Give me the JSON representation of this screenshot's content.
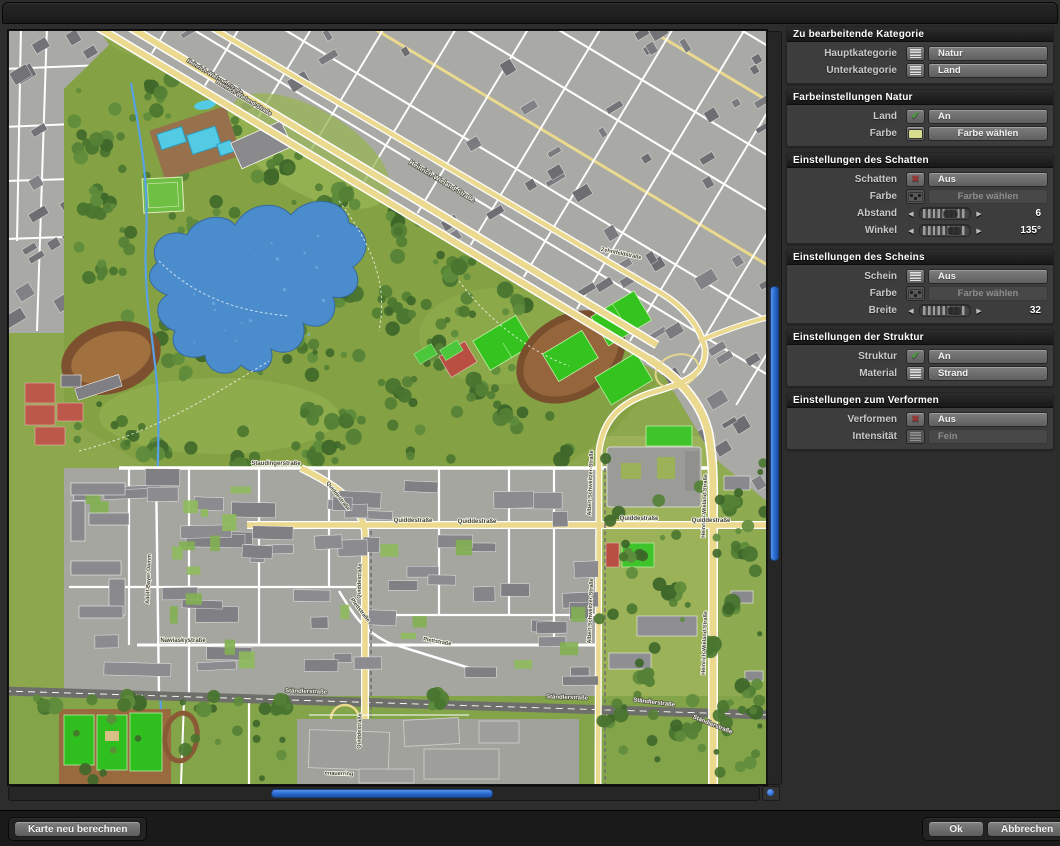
{
  "panel": {
    "sections": [
      {
        "title": "Zu bearbeitende Kategorie",
        "rows": [
          {
            "label": "Hauptkategorie",
            "type": "combo",
            "icon": "menu-icon",
            "value": "Natur"
          },
          {
            "label": "Unterkategorie",
            "type": "combo",
            "icon": "menu-icon",
            "value": "Land"
          }
        ]
      },
      {
        "title": "Farbeinstellungen Natur",
        "rows": [
          {
            "label": "Land",
            "type": "combo",
            "icon": "check-icon",
            "value": "An"
          },
          {
            "label": "Farbe",
            "type": "color",
            "icon": "swatch-icon",
            "value": "Farbe wählen"
          }
        ]
      },
      {
        "title": "Einstellungen des Schatten",
        "rows": [
          {
            "label": "Schatten",
            "type": "combo",
            "icon": "x-icon",
            "value": "Aus"
          },
          {
            "label": "Farbe",
            "type": "color",
            "icon": "checker-swatch-icon",
            "value": "Farbe wählen",
            "disabled": true
          },
          {
            "label": "Abstand",
            "type": "slider",
            "value": "6",
            "handle_frac": 0.62
          },
          {
            "label": "Winkel",
            "type": "slider",
            "value": "135°",
            "handle_frac": 0.72
          }
        ]
      },
      {
        "title": "Einstellungen des Scheins",
        "rows": [
          {
            "label": "Schein",
            "type": "combo",
            "icon": "menu-icon",
            "value": "Aus"
          },
          {
            "label": "Farbe",
            "type": "color",
            "icon": "checker-swatch-icon",
            "value": "Farbe wählen",
            "disabled": true
          },
          {
            "label": "Breite",
            "type": "slider",
            "value": "32",
            "handle_frac": 0.72
          }
        ]
      },
      {
        "title": "Einstellungen der Struktur",
        "rows": [
          {
            "label": "Struktur",
            "type": "combo",
            "icon": "check-icon",
            "value": "An"
          },
          {
            "label": "Material",
            "type": "combo",
            "icon": "menu-icon",
            "value": "Strand"
          }
        ]
      },
      {
        "title": "Einstellungen zum Verformen",
        "rows": [
          {
            "label": "Verformen",
            "type": "combo",
            "icon": "x-icon",
            "value": "Aus"
          },
          {
            "label": "Intensität",
            "type": "combo",
            "icon": "menu-icon",
            "value": "Fein",
            "disabled": true
          }
        ]
      }
    ]
  },
  "footer": {
    "recalculate": "Karte neu berechnen",
    "ok": "Ok",
    "cancel": "Abbrechen"
  },
  "colors": {
    "accent_blue": "#2e6fd6",
    "swatch_yellow_green": "#d7dd8d",
    "check_green": "#3fa32f",
    "cross_red": "#9e3434"
  },
  "map": {
    "labels": [
      {
        "text": "Heinrich-Wieland-Straße",
        "x": 205,
        "y": 47,
        "rot": 31,
        "style": "light",
        "size": 5.5
      },
      {
        "text": "Heinrich-Wieland-Straße",
        "x": 234,
        "y": 68,
        "rot": 31,
        "style": "light",
        "size": 5.5
      },
      {
        "text": "Heinrich-Wieland-Straße",
        "x": 432,
        "y": 152,
        "rot": 31,
        "style": "light",
        "size": 6.5
      },
      {
        "text": "Heinrich-Wieland-Straße",
        "x": 697,
        "y": 475,
        "rot": -88,
        "style": "dark",
        "size": 5.5
      },
      {
        "text": "Heinrich-Wieland-Straße",
        "x": 697,
        "y": 612,
        "rot": -88,
        "style": "dark",
        "size": 5.5
      },
      {
        "text": "Zehntfeldstraße",
        "x": 612,
        "y": 224,
        "rot": 12,
        "style": "dark",
        "size": 5.5
      },
      {
        "text": "Staudingerstraße",
        "x": 267,
        "y": 434,
        "rot": 0,
        "style": "dark",
        "size": 6
      },
      {
        "text": "Quiddestraße",
        "x": 328,
        "y": 466,
        "rot": 52,
        "style": "dark",
        "size": 5.5
      },
      {
        "text": "Quiddestraße",
        "x": 404,
        "y": 491,
        "rot": 0,
        "style": "dark",
        "size": 6
      },
      {
        "text": "Quiddestraße",
        "x": 468,
        "y": 492,
        "rot": 0,
        "style": "dark",
        "size": 6
      },
      {
        "text": "Quiddestraße",
        "x": 630,
        "y": 489,
        "rot": 0,
        "style": "dark",
        "size": 6
      },
      {
        "text": "Quiddestraße",
        "x": 702,
        "y": 491,
        "rot": 0,
        "style": "dark",
        "size": 6
      },
      {
        "text": "Quiddestraße",
        "x": 352,
        "y": 550,
        "rot": -88,
        "style": "dark",
        "size": 5.5
      },
      {
        "text": "Quiddestraße",
        "x": 352,
        "y": 700,
        "rot": -88,
        "style": "dark",
        "size": 5.5
      },
      {
        "text": "Plettstraße",
        "x": 350,
        "y": 580,
        "rot": 52,
        "style": "dark",
        "size": 5.5
      },
      {
        "text": "Plettstraße",
        "x": 428,
        "y": 612,
        "rot": 10,
        "style": "dark",
        "size": 5.5
      },
      {
        "text": "Nawiaskystraße",
        "x": 174,
        "y": 611,
        "rot": 0,
        "style": "dark",
        "size": 6
      },
      {
        "text": "Adolf-Bayer-Damm",
        "x": 141,
        "y": 548,
        "rot": -88,
        "style": "dark",
        "size": 5.5
      },
      {
        "text": "Albert-Schweitzer-Straße",
        "x": 583,
        "y": 452,
        "rot": -88,
        "style": "dark",
        "size": 5.5
      },
      {
        "text": "Albert-Schweitzer-Straße",
        "x": 583,
        "y": 580,
        "rot": -88,
        "style": "dark",
        "size": 5.5
      },
      {
        "text": "Ständlerstraße",
        "x": 297,
        "y": 662,
        "rot": 2,
        "style": "light",
        "size": 6
      },
      {
        "text": "Ständlerstraße",
        "x": 558,
        "y": 668,
        "rot": 2,
        "style": "light",
        "size": 6
      },
      {
        "text": "Ständlerstraße",
        "x": 645,
        "y": 673,
        "rot": 7,
        "style": "light",
        "size": 6
      },
      {
        "text": "Ständlerstraße",
        "x": 703,
        "y": 695,
        "rot": 22,
        "style": "light",
        "size": 6
      },
      {
        "text": "enauerring",
        "x": 330,
        "y": 744,
        "rot": 2,
        "style": "dark",
        "size": 5.5
      }
    ]
  }
}
